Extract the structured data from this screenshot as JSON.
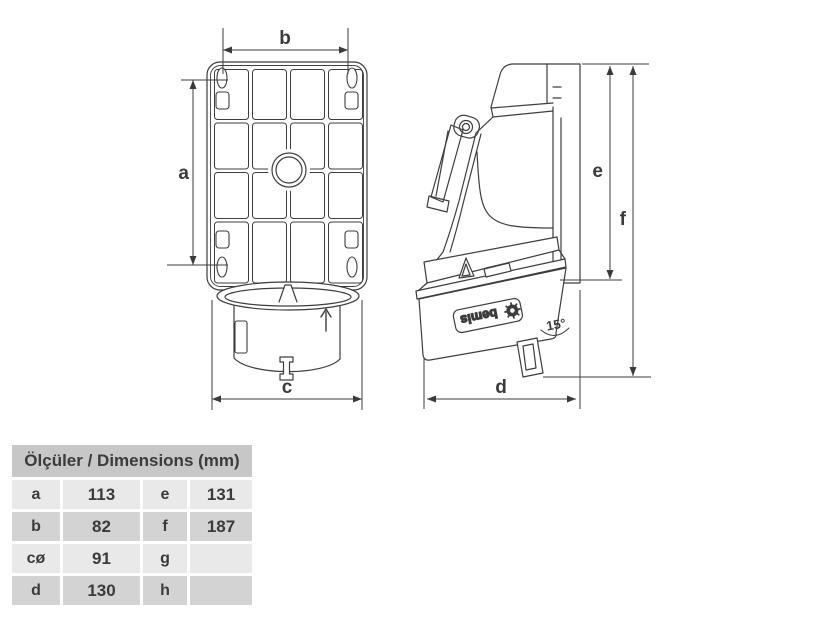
{
  "colors": {
    "header-bg": "#c7c7c7",
    "row-light": "#e9e9e9",
    "row-dark": "#d3d3d3",
    "text-color": "#3b3b3b",
    "line-color": "#3d3d3d",
    "page-bg": "#ffffff"
  },
  "labels": {
    "dim_a": "a",
    "dim_b": "b",
    "dim_c": "c",
    "dim_d": "d",
    "dim_e": "e",
    "dim_f": "f",
    "angle": "15°",
    "brand": "bemis"
  },
  "table": {
    "title": "Ölçüler / Dimensions (mm)",
    "rows": [
      {
        "key1": "a",
        "val1": "113",
        "key2": "e",
        "val2": "131"
      },
      {
        "key1": "b",
        "val1": "82",
        "key2": "f",
        "val2": "187"
      },
      {
        "key1": "cø",
        "val1": "91",
        "key2": "g",
        "val2": ""
      },
      {
        "key1": "d",
        "val1": "130",
        "key2": "h",
        "val2": ""
      }
    ]
  }
}
